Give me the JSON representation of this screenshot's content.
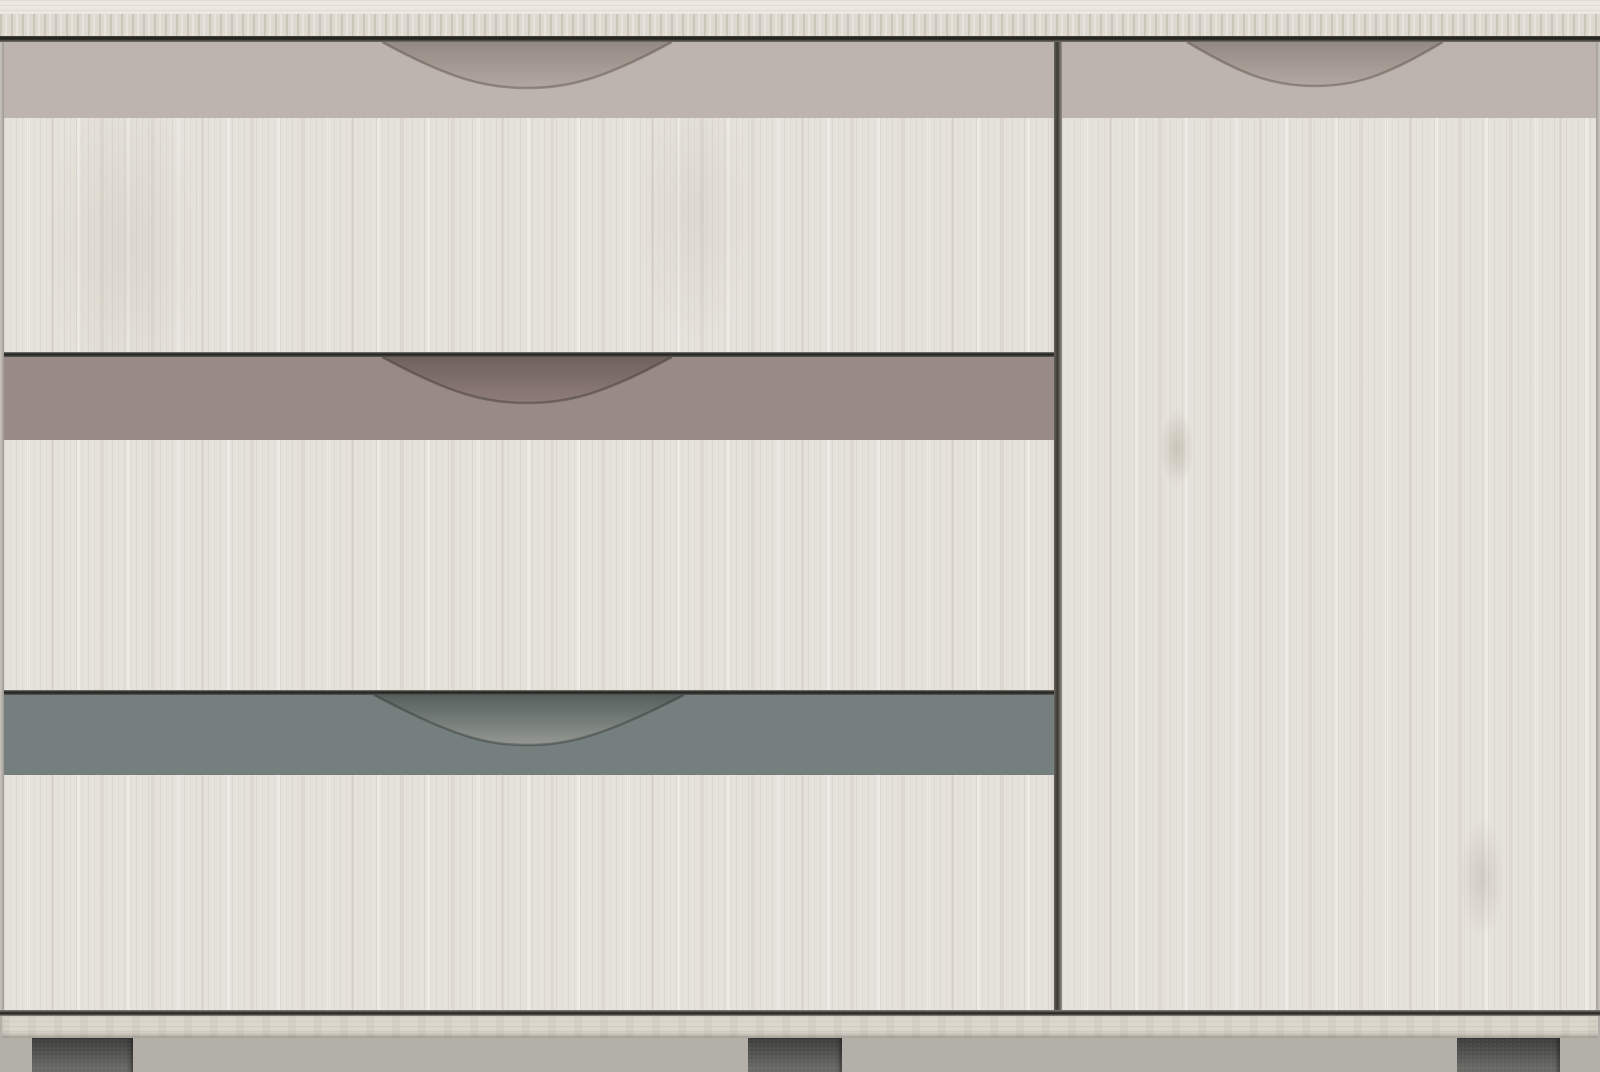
{
  "image": {
    "kind": "product-photo",
    "subject": "whitewashed wood sideboard with three accent drawers and one door",
    "width_px": 1600,
    "height_px": 1072
  },
  "colors": {
    "floor": "#b3b0a9",
    "top_surface": "#ebe8e1",
    "top_edge": "#ded9d0",
    "shadow_dark": "#1c1b17",
    "wood_base": "#e5e2db",
    "side_edge": "#ccc7be",
    "accent_beige": "#bdb4ae",
    "accent_mauve": "#998a87",
    "accent_teal": "#75807e",
    "recess_beige_dark": "#948a83",
    "recess_beige_light": "#b2a8a1",
    "recess_mauve_dark": "#6f615e",
    "recess_mauve_light": "#8f7d79",
    "recess_teal_dark": "#55605d",
    "recess_teal_light": "#949893",
    "divider": "#3a3833",
    "gap_line": "#1f1e1b",
    "plinth": "#dcd7ce",
    "foot_dark": "#3c3c3a",
    "foot_light": "#5f5f5c"
  },
  "cabinet": {
    "left_section": {
      "drawers": [
        {
          "position": "top",
          "accent_color_ref": "accent_beige",
          "handle": "curved-cutout"
        },
        {
          "position": "middle",
          "accent_color_ref": "accent_mauve",
          "handle": "curved-cutout"
        },
        {
          "position": "bottom",
          "accent_color_ref": "accent_teal",
          "handle": "curved-cutout"
        }
      ]
    },
    "right_section": {
      "door": {
        "accent_color_ref": "accent_beige",
        "handle": "curved-cutout"
      }
    },
    "feet_count": 3
  }
}
